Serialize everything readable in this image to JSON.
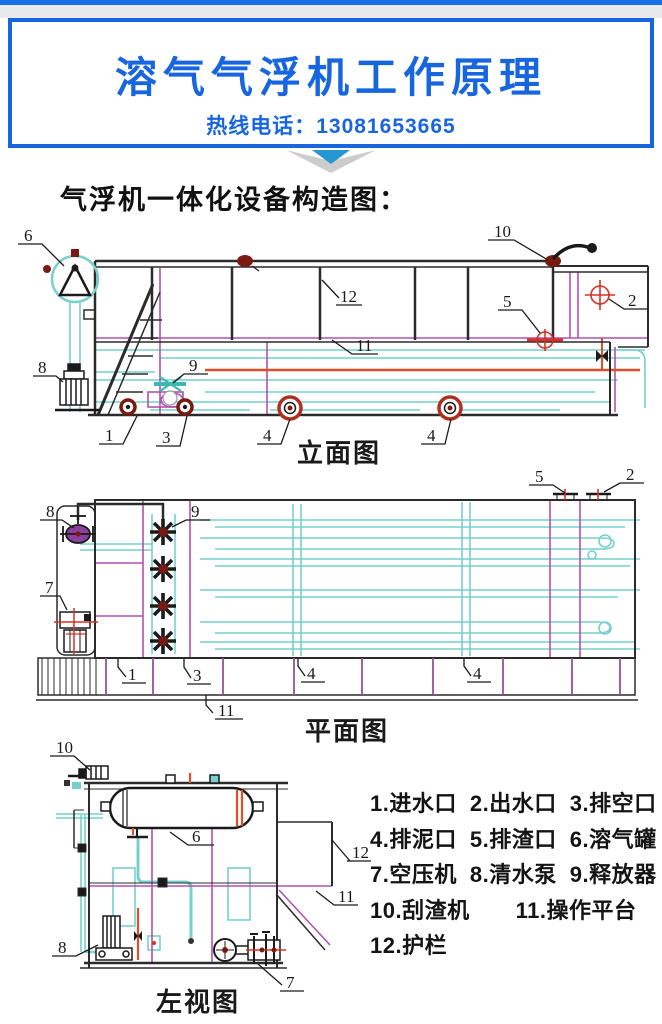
{
  "header": {
    "title": "溶气气浮机工作原理",
    "hotline_label": "热线电话：",
    "hotline_number": "13081653665"
  },
  "section_title": "气浮机一体化设备构造图：",
  "diagrams": {
    "elevation": {
      "caption": "立面图",
      "callouts": [
        {
          "t": "6",
          "x": 24,
          "y": 19
        },
        {
          "t": "10",
          "x": 494,
          "y": 15
        },
        {
          "t": "12",
          "x": 340,
          "y": 80
        },
        {
          "t": "11",
          "x": 356,
          "y": 129
        },
        {
          "t": "5",
          "x": 503,
          "y": 85
        },
        {
          "t": "2",
          "x": 628,
          "y": 84
        },
        {
          "t": "9",
          "x": 189,
          "y": 149
        },
        {
          "t": "8",
          "x": 38,
          "y": 151
        },
        {
          "t": "1",
          "x": 105,
          "y": 219
        },
        {
          "t": "3",
          "x": 162,
          "y": 221
        },
        {
          "t": "4",
          "x": 263,
          "y": 219
        },
        {
          "t": "4",
          "x": 427,
          "y": 219
        }
      ]
    },
    "plan": {
      "caption": "平面图",
      "callouts": [
        {
          "t": "8",
          "x": 46,
          "y": 53
        },
        {
          "t": "9",
          "x": 191,
          "y": 53
        },
        {
          "t": "7",
          "x": 45,
          "y": 129
        },
        {
          "t": "5",
          "x": 535,
          "y": 18
        },
        {
          "t": "2",
          "x": 626,
          "y": 16
        },
        {
          "t": "1",
          "x": 128,
          "y": 216
        },
        {
          "t": "3",
          "x": 193,
          "y": 217
        },
        {
          "t": "4",
          "x": 307,
          "y": 215
        },
        {
          "t": "4",
          "x": 473,
          "y": 215
        },
        {
          "t": "11",
          "x": 218,
          "y": 252
        }
      ]
    },
    "side": {
      "caption": "左视图",
      "callouts": [
        {
          "t": "10",
          "x": 56,
          "y": 13
        },
        {
          "t": "6",
          "x": 192,
          "y": 102
        },
        {
          "t": "12",
          "x": 352,
          "y": 118
        },
        {
          "t": "11",
          "x": 338,
          "y": 162
        },
        {
          "t": "8",
          "x": 58,
          "y": 213
        },
        {
          "t": "7",
          "x": 286,
          "y": 248
        }
      ]
    }
  },
  "legend": {
    "rows": [
      [
        "1.进水口",
        "2.出水口",
        "3.排空口"
      ],
      [
        "4.排泥口",
        "5.排渣口",
        "6.溶气罐"
      ],
      [
        "7.空压机",
        "8.清水泵",
        "9.释放器"
      ],
      [
        "10.刮渣机",
        "11.操作平台"
      ],
      [
        "12.护栏"
      ]
    ]
  },
  "colors": {
    "accent_blue": "#1766e0",
    "arrow_blue": "#2596d1",
    "pipe_teal": "#76d0cd",
    "line_magenta": "#b052ae",
    "pipe_orange": "#dd4f28",
    "dark_red": "#7a1a10",
    "marker_red": "#d93025"
  }
}
